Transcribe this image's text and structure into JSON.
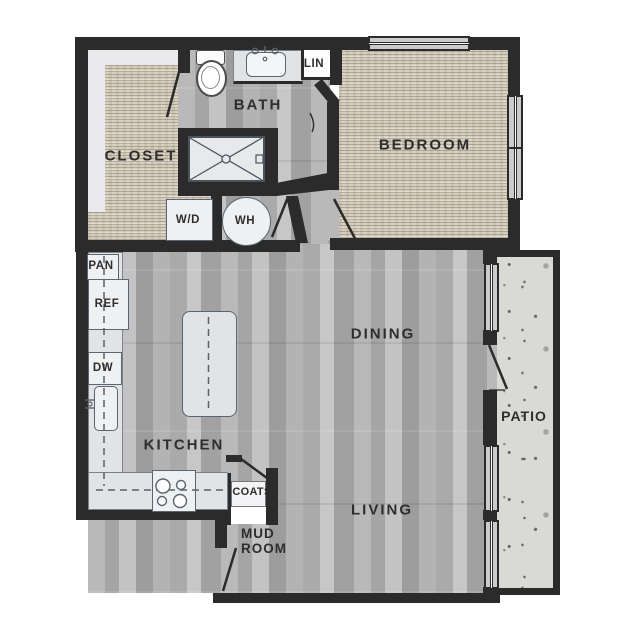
{
  "plan": {
    "title": "one-bedroom apartment floor plan",
    "rooms": {
      "closet": {
        "label": "CLOSET"
      },
      "bath": {
        "label": "BATH"
      },
      "bedroom": {
        "label": "BEDROOM"
      },
      "kitchen": {
        "label": "KITCHEN"
      },
      "dining": {
        "label": "DINING"
      },
      "living": {
        "label": "LIVING"
      },
      "patio": {
        "label": "PATIO"
      },
      "mud_room": {
        "label": "MUD ROOM"
      }
    },
    "fixtures": {
      "linen_closet": {
        "label": "LIN"
      },
      "washer_dryer": {
        "label": "W/D"
      },
      "water_heater": {
        "label": "WH"
      },
      "pantry": {
        "label": "PAN"
      },
      "refrigerator": {
        "label": "REF"
      },
      "dishwasher": {
        "label": "DW"
      },
      "coat_closet": {
        "label": "COATS"
      }
    },
    "colors": {
      "wall": "#2b2b2b",
      "wood_floor": "#adadad",
      "carpet": "#d7d0c0",
      "concrete": "#d9d9d5",
      "counter": "#e2e3e5",
      "fixture_outline": "#5a6570",
      "label_text": "#2e2e2e"
    }
  }
}
